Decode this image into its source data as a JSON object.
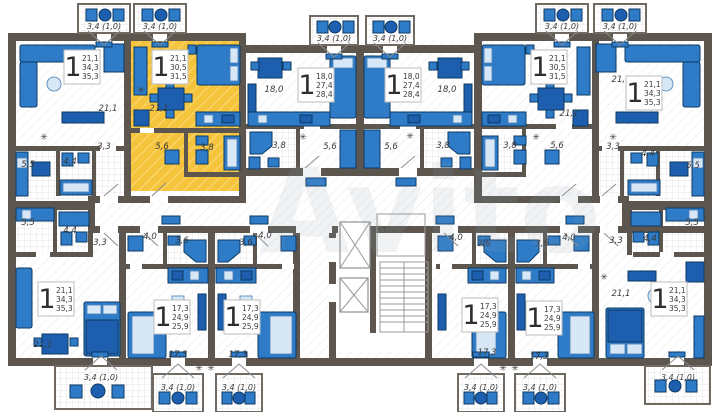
{
  "watermark": "Avito",
  "icons": {
    "vent": "✳"
  },
  "colors": {
    "highlight": "#f5c33c",
    "furniture": "#2e7bc8",
    "wall": "#5c564f"
  },
  "apartments": [
    {
      "id": "top-left-corner",
      "rooms": "1",
      "living_area": "21,1",
      "usable_area": "34,3",
      "total_area": "35,3",
      "balcony": "3,4 (1,0)",
      "room_labels": {
        "living": "21,1",
        "hall": "3,3",
        "bathroom": "4,4",
        "kitchen": "5,5"
      }
    },
    {
      "id": "top-highlighted",
      "rooms": "1",
      "living_area": "21,1",
      "usable_area": "30,5",
      "total_area": "31,5",
      "balcony": "3,4 (1,0)",
      "highlighted": true,
      "room_labels": {
        "living": "21,1",
        "hall": "5,6",
        "bathroom": "3,8"
      }
    },
    {
      "id": "top-mid-left",
      "rooms": "1",
      "living_area": "18,0",
      "usable_area": "27,4",
      "total_area": "28,4",
      "balcony": "3,4 (1,0)",
      "room_labels": {
        "living": "18,0",
        "hall": "5,6",
        "bathroom": "3,8"
      }
    },
    {
      "id": "top-mid-right",
      "rooms": "1",
      "living_area": "18,0",
      "usable_area": "27,4",
      "total_area": "28,4",
      "balcony": "3,4 (1,0)",
      "room_labels": {
        "living": "18,0",
        "hall": "5,6",
        "bathroom": "3,8"
      }
    },
    {
      "id": "top-right-2nd",
      "rooms": "1",
      "living_area": "21,1",
      "usable_area": "30,5",
      "total_area": "31,5",
      "balcony": "3,4 (1,0)",
      "room_labels": {
        "living": "21,1",
        "hall": "5,6",
        "bathroom": "3,8"
      }
    },
    {
      "id": "top-right-corner",
      "rooms": "1",
      "living_area": "21,1",
      "usable_area": "34,3",
      "total_area": "35,3",
      "balcony": "3,4 (1,0)",
      "room_labels": {
        "living": "21,1",
        "hall": "3,3",
        "bathroom": "4,4",
        "kitchen": "5,5"
      }
    },
    {
      "id": "bottom-left-corner",
      "rooms": "1",
      "living_area": "21,1",
      "usable_area": "34,3",
      "total_area": "35,3",
      "balcony": "3,4 (1,0)",
      "room_labels": {
        "living": "21,1",
        "hall": "3,3",
        "bathroom": "4,4",
        "kitchen": "5,5"
      }
    },
    {
      "id": "bottom-studio-1",
      "rooms": "1",
      "living_area": "17,3",
      "usable_area": "24,9",
      "total_area": "25,9",
      "balcony": "3,4 (1,0)",
      "room_labels": {
        "living": "17,3",
        "hall": "4,0",
        "bathroom": "3,6"
      }
    },
    {
      "id": "bottom-studio-2",
      "rooms": "1",
      "living_area": "17,3",
      "usable_area": "24,9",
      "total_area": "25,9",
      "balcony": "3,4 (1,0)",
      "room_labels": {
        "living": "17,3",
        "hall": "4,0",
        "bathroom": "3,6"
      }
    },
    {
      "id": "bottom-studio-3",
      "rooms": "1",
      "living_area": "17,3",
      "usable_area": "24,9",
      "total_area": "25,9",
      "balcony": "3,4 (1,0)",
      "room_labels": {
        "living": "17,3",
        "hall": "4,0",
        "bathroom": "3,6"
      }
    },
    {
      "id": "bottom-studio-4",
      "rooms": "1",
      "living_area": "17,3",
      "usable_area": "24,9",
      "total_area": "25,9",
      "balcony": "3,4 (1,0)",
      "room_labels": {
        "living": "17,3",
        "hall": "4,0",
        "bathroom": "3,6"
      }
    },
    {
      "id": "bottom-right-corner",
      "rooms": "1",
      "living_area": "21,1",
      "usable_area": "34,3",
      "total_area": "35,3",
      "balcony": "3,4 (1,0)",
      "room_labels": {
        "living": "21,1",
        "hall": "3,3",
        "bathroom": "4,4",
        "kitchen": "5,5"
      }
    }
  ]
}
